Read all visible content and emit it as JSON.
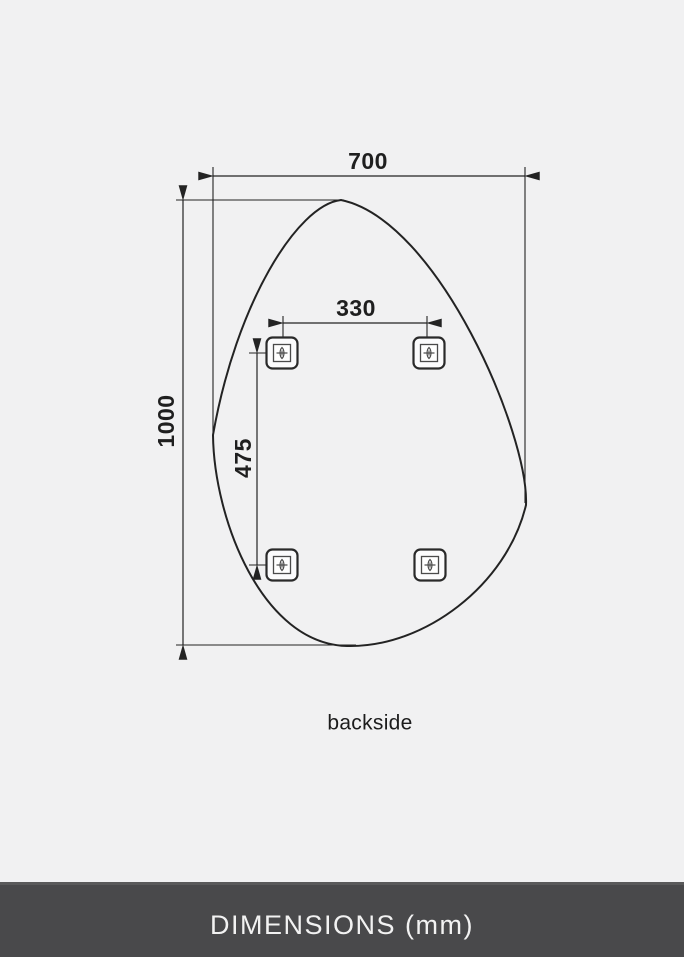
{
  "diagram": {
    "caption": "backside",
    "dimensions": {
      "width": {
        "label": "700",
        "unit": "mm"
      },
      "height": {
        "label": "1000",
        "unit": "mm"
      },
      "bracket_spacing_horizontal": {
        "label": "330",
        "unit": "mm"
      },
      "bracket_spacing_vertical": {
        "label": "475",
        "unit": "mm"
      }
    },
    "icons": {
      "bracket": "mounting-bracket-screw-icon"
    },
    "bracket_count": 4
  },
  "footer": {
    "title": "DIMENSIONS (mm)"
  },
  "colors": {
    "background": "#f1f1f2",
    "line": "#232323",
    "footer_background": "#49494b",
    "footer_text": "#f2f2f2"
  }
}
